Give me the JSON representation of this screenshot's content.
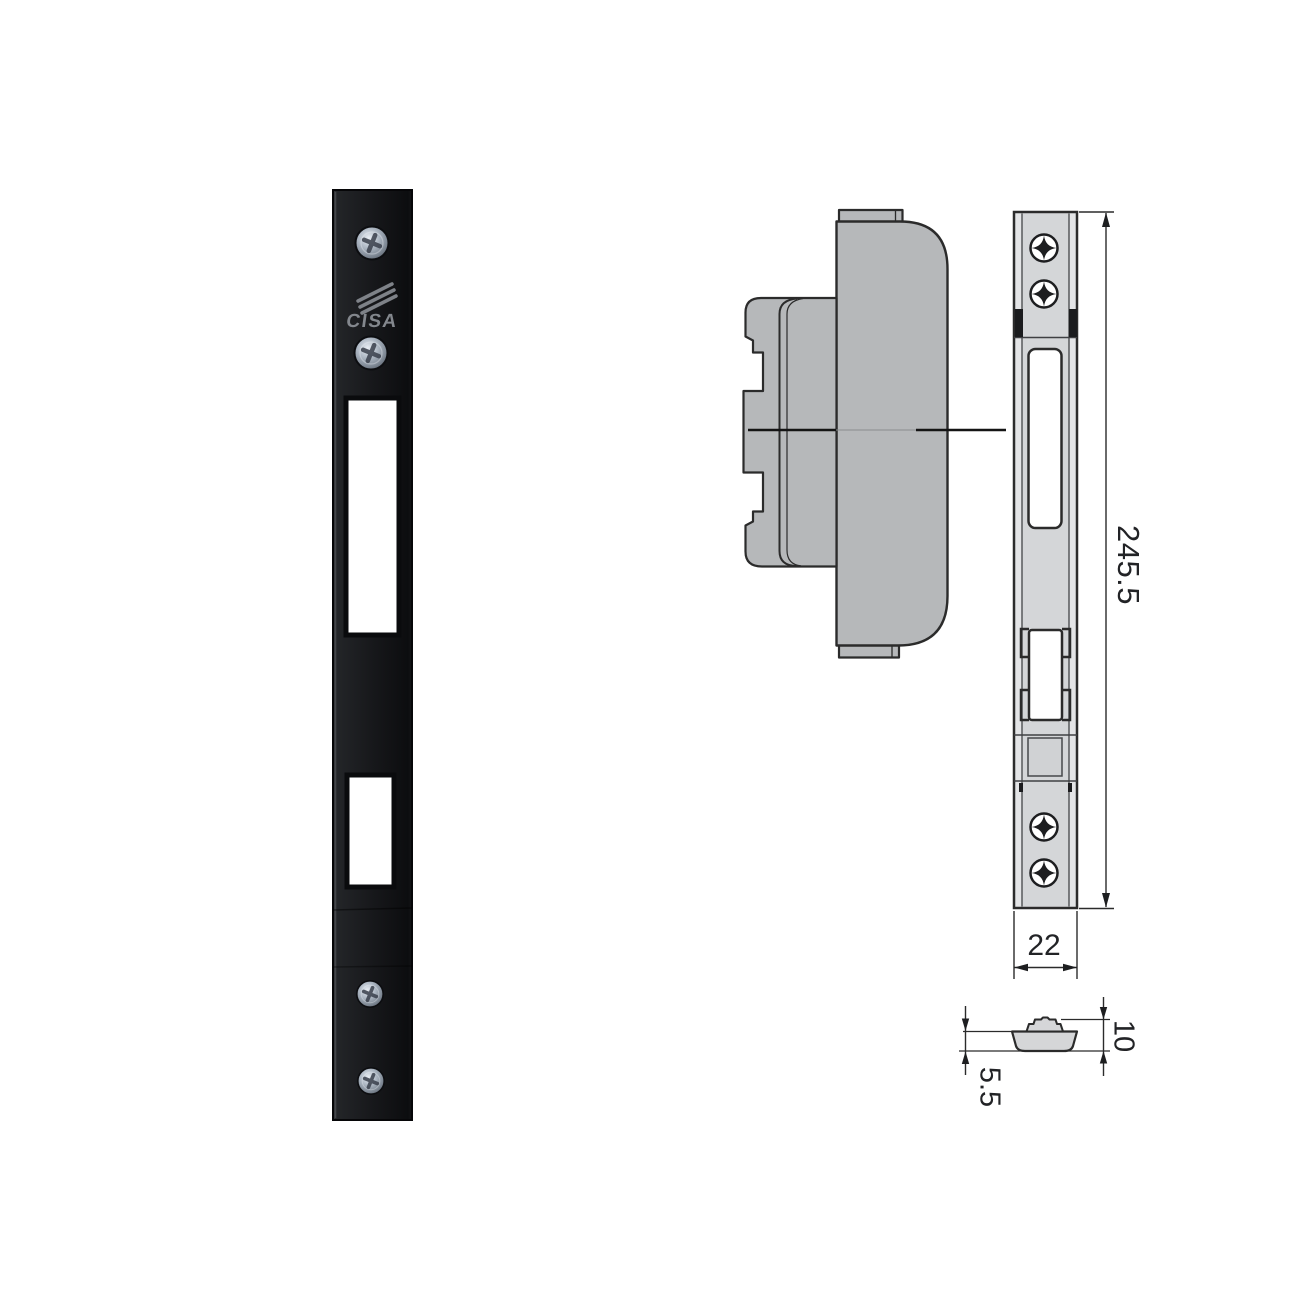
{
  "photo": {
    "brand": "CISA"
  },
  "dimensions": {
    "overall_height_mm": "245.5",
    "plate_width_mm": "22",
    "overall_depth_mm": "10",
    "cup_depth_mm": "5.5"
  },
  "colors": {
    "background": "#ffffff",
    "drawing_outline": "#2b2b2b",
    "lock_body_fill": "#b6b8ba",
    "plate_fill": "#e3e4e6",
    "plate_column_fill": "#d4d6d8",
    "photo_plate_fill": "#17181b",
    "dimension_text": "#222326",
    "logo_text": "#83878d"
  }
}
